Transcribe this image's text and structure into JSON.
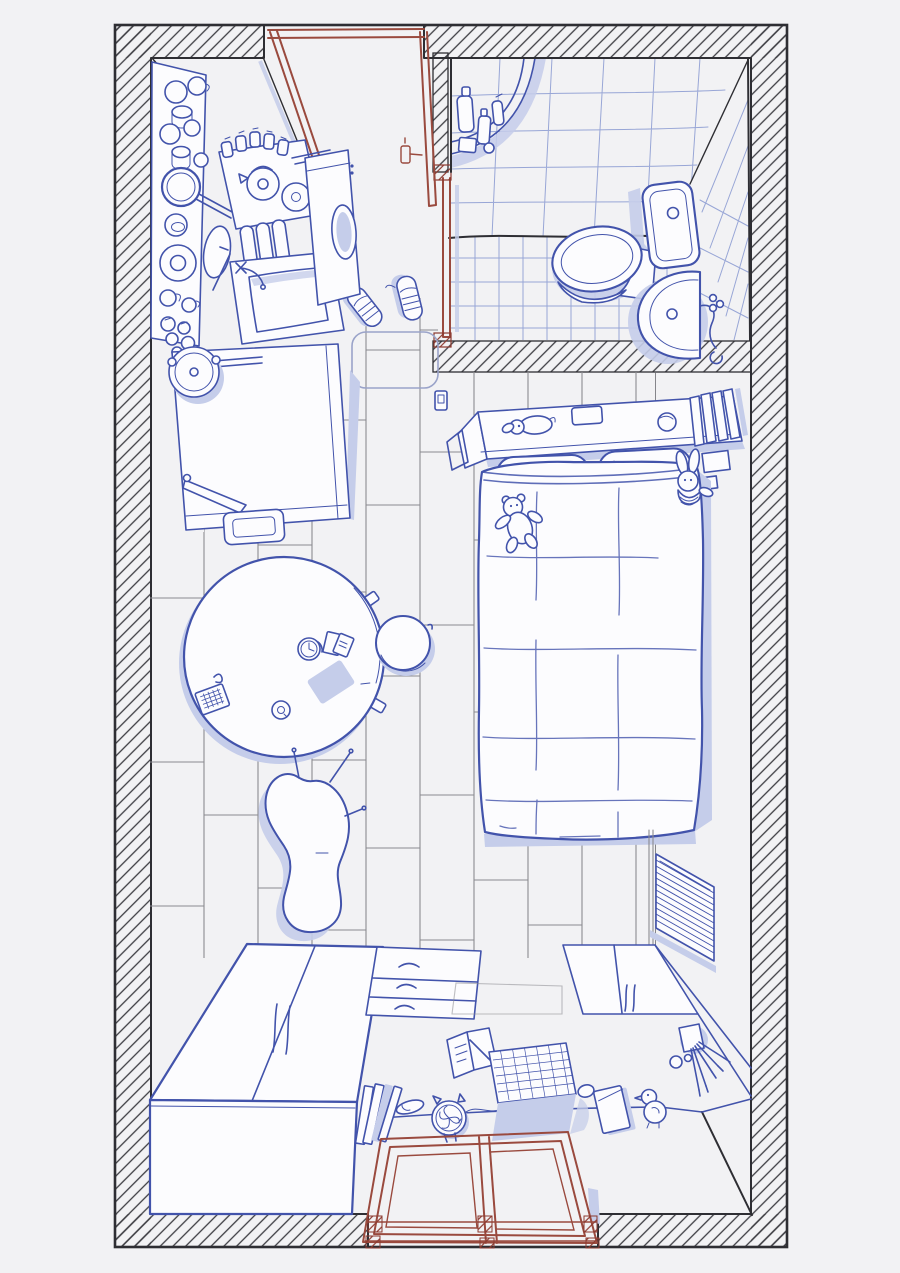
{
  "meta": {
    "width": 900,
    "height": 1273
  },
  "palette": {
    "paper": "#f2f2f4",
    "white": "#fcfcfe",
    "ink": "#4253ab",
    "inkdeep": "#32409b",
    "shade": "#c5cdea",
    "wall": "#2e2e33",
    "hatch": "#3c3c41",
    "red": "#9a4a3e",
    "redeep": "#8c3a30",
    "floorline": "#8b8b90",
    "tile": "#98a6d6"
  },
  "scene": {
    "style": "hand-drawn ink line art, top-down apartment view",
    "rooms": [
      {
        "name": "entry",
        "items": [
          "front-door-open",
          "door-handle",
          "door-frame",
          "doormat",
          "sneakers-pair"
        ]
      },
      {
        "name": "kitchen",
        "items": [
          "wall-counter",
          "mugs-and-cups",
          "saucepan",
          "bowl",
          "plate",
          "sauce-jars",
          "stove",
          "kettle",
          "burner",
          "spice-jars",
          "chopsticks",
          "dish-rack",
          "cutting-board",
          "sink",
          "faucet",
          "washing-machine",
          "fridge",
          "rice-cooker",
          "step-box",
          "spatula"
        ]
      },
      {
        "name": "bathroom",
        "items": [
          "tiled-walls",
          "tiled-floor",
          "corner-shower-shelf",
          "shampoo-bottles",
          "bathroom-door-open",
          "toilet-tank",
          "flush-button",
          "toilet-bowl",
          "wash-basin",
          "basin-faucet"
        ]
      },
      {
        "name": "bedroom",
        "items": [
          "headboard-shelf",
          "plush-dog",
          "small-box",
          "ball",
          "book-stack",
          "pillow",
          "pillow",
          "quilted-blanket",
          "teddy-bear",
          "bunny-plush",
          "wall-frames",
          "light-switch",
          "radiator"
        ]
      },
      {
        "name": "living-area",
        "items": [
          "wood-plank-floor",
          "round-table",
          "calculator",
          "clip",
          "alarm-clock",
          "note-cards",
          "tablet",
          "coaster",
          "chair-tabs",
          "round-stool",
          "bean-chair"
        ]
      },
      {
        "name": "work-storage",
        "items": [
          "wardrobe",
          "drawer-unit",
          "double-door-cabinet",
          "desk",
          "leaning-books",
          "slipper",
          "desk-fan",
          "open-notebook",
          "pen",
          "laptop",
          "mouse",
          "notepad",
          "duck-toy",
          "brush-cup",
          "window-frame"
        ]
      }
    ]
  }
}
